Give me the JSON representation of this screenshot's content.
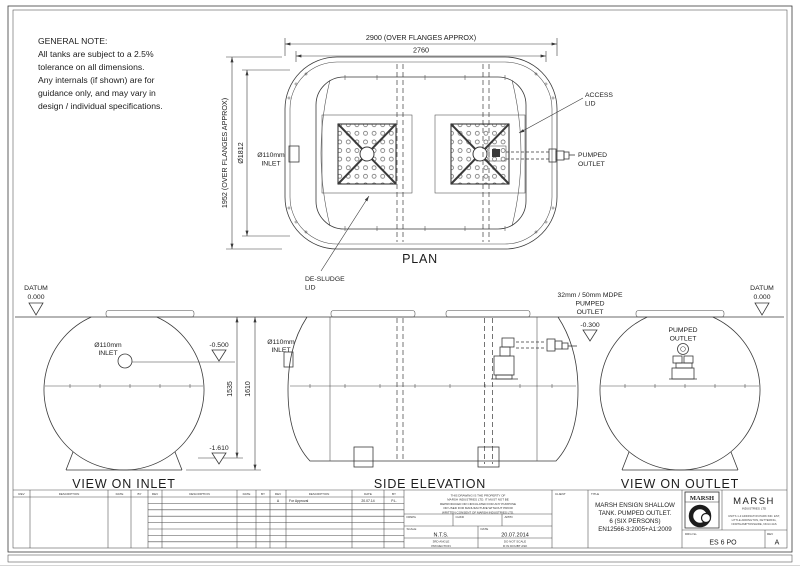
{
  "general_note": {
    "title": "GENERAL NOTE:",
    "lines": [
      "All tanks are subject to a 2.5%",
      "tolerance on all dimensions.",
      "Any internals (if shown) are for",
      "guidance only, and may vary in",
      "design / individual specifications."
    ]
  },
  "plan": {
    "caption": "PLAN",
    "dims": {
      "overall_width": "2900 (OVER FLANGES APPROX)",
      "body_width": "2760",
      "overall_height": "1952 (OVER FLANGES APPROX)",
      "body_diameter": "Ø1812"
    },
    "labels": {
      "inlet": [
        "Ø110mm",
        "INLET"
      ],
      "access_lid": [
        "ACCESS",
        "LID"
      ],
      "pumped_outlet": [
        "PUMPED",
        "OUTLET"
      ],
      "desludge_lid": [
        "DE-SLUDGE",
        "LID"
      ]
    }
  },
  "elevations": {
    "datum_left": {
      "label": "DATUM",
      "value": "0.000"
    },
    "datum_right": {
      "label": "DATUM",
      "value": "0.000"
    },
    "view_inlet": {
      "caption": "VIEW ON INLET",
      "inlet_label": [
        "Ø110mm",
        "INLET"
      ],
      "inlet_invert": "-0.500",
      "height_internal": "1535",
      "height_overall": "1610",
      "base_level": "-1.610"
    },
    "side_elevation": {
      "caption": "SIDE ELEVATION",
      "inlet_label": [
        "Ø110mm",
        "INLET"
      ],
      "outlet_label": [
        "32mm / 50mm MDPE",
        "PUMPED",
        "OUTLET"
      ],
      "outlet_invert": "-0.300"
    },
    "view_outlet": {
      "caption": "VIEW ON OUTLET",
      "outlet_label": [
        "PUMPED",
        "OUTLET"
      ]
    }
  },
  "title_block": {
    "rev_headers": [
      "REV",
      "DESCRIPTION",
      "DATE",
      "BY"
    ],
    "revision_row": {
      "rev": "A",
      "description": "For Approval",
      "date": "20.07.14",
      "by": "P.L."
    },
    "disclaimer_lines": [
      "THIS DRAWING IS THE PROPERTY OF",
      "MARSH INDUSTRIES LTD. IT MUST NOT BE",
      "REPRODUCED OR CIRCULATED FOR ANY PURPOSE",
      "OR USED FOR MANUFACTURE WITHOUT PRIOR",
      "WRITTEN CONSENT OF MARSH INDUSTRIES LTD."
    ],
    "approval_cells": [
      "DRWG",
      "CHKD",
      "APPD"
    ],
    "scale": {
      "label": "SCALE",
      "value": "N.T.S."
    },
    "date": {
      "label": "DATE",
      "value": "20.07.2014"
    },
    "projection": [
      "3RD ANGLE",
      "PROJECTION"
    ],
    "do_not_scale": [
      "DO NOT SCALE",
      "IF IN DOUBT ASK"
    ],
    "client_label": "CLIENT",
    "title_label": "TITLE",
    "title_lines": [
      "MARSH ENSIGN SHALLOW",
      "TANK. PUMPED OUTLET.",
      "6 (SIX PERSONS)",
      "EN12566-3:2005+A1:2009"
    ],
    "logo_word": "MARSH",
    "company": {
      "name": "MARSH",
      "subtitle": "INDUSTRIES LTD",
      "address": [
        "UNITS 1-3 ADDINGTON PARK IND. EST,",
        "LITTLE ADDINGTON, KETTERING,",
        "NORTHAMPTONSHIRE, NN14 4AS"
      ]
    },
    "drg": {
      "label": "DRG No.",
      "value": "ES 6 PO"
    },
    "rev": {
      "label": "REV",
      "value": "A"
    }
  }
}
